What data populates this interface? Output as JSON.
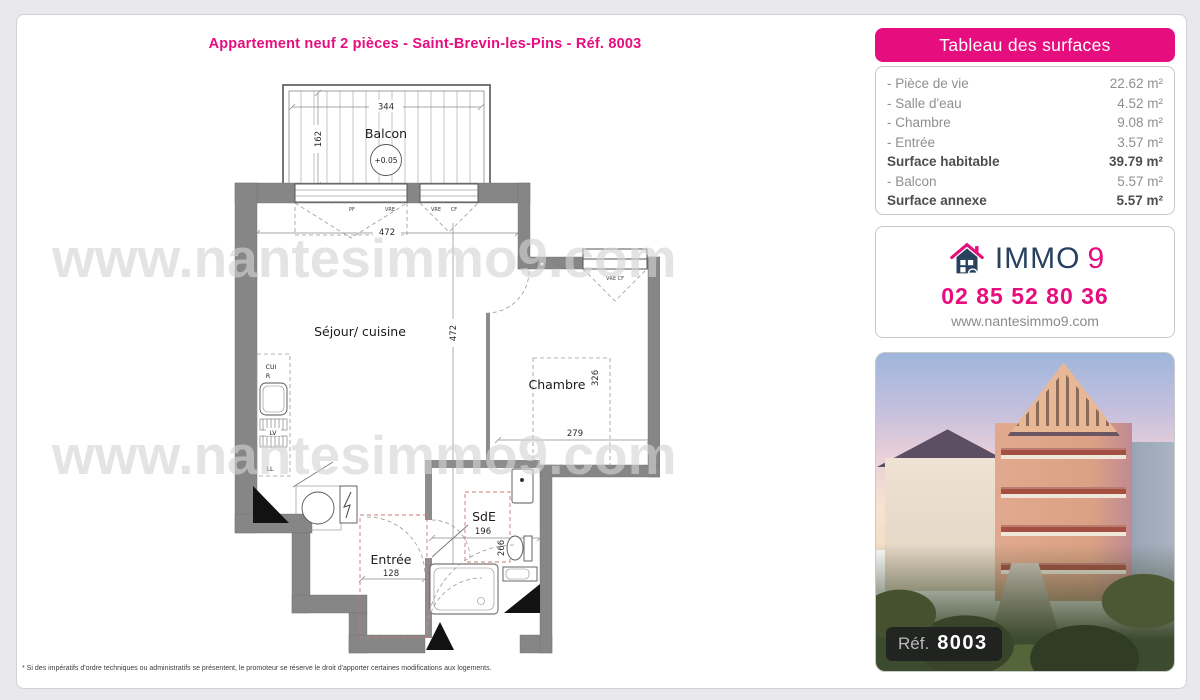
{
  "page": {
    "title": "Appartement neuf 2 pièces - Saint-Brevin-les-Pins - Réf. 8003",
    "watermark": "www.nantesimmo9.com",
    "footnote": "* Si des impératifs d'ordre techniques ou administratifs se présentent, le promoteur se réserve le droit d'apporter certaines modifications aux logements."
  },
  "surfaces_table": {
    "header": "Tableau des surfaces",
    "rows": [
      {
        "label": "- Pièce de vie",
        "value": "22.62 m²"
      },
      {
        "label": "- Salle d'eau",
        "value": "4.52 m²"
      },
      {
        "label": "- Chambre",
        "value": "9.08 m²"
      },
      {
        "label": "- Entrée",
        "value": "3.57 m²"
      },
      {
        "label": "Surface habitable",
        "value": "39.79 m²"
      },
      {
        "label": "- Balcon",
        "value": "5.57 m²"
      },
      {
        "label": "Surface annexe",
        "value": "5.57 m²"
      }
    ]
  },
  "contact": {
    "brand_immo": "IMMO",
    "brand_nine": "9",
    "phone": "02 85 52 80 36",
    "website": "www.nantesimmo9.com"
  },
  "photo": {
    "ref_label": "Réf.",
    "ref_number": "8003"
  },
  "plan": {
    "rooms": {
      "balcon": "Balcon",
      "sejour": "Séjour/ cuisine",
      "chambre": "Chambre",
      "sde": "SdE",
      "entree": "Entrée"
    },
    "elevation": "+0.05",
    "dims": {
      "balcon_w": "344",
      "balcon_h": "162",
      "sejour_w": "472",
      "sejour_h": "472",
      "chambre_w": "279",
      "chambre_h": "326",
      "sde_w": "196",
      "sde_h": "266",
      "entree_w": "128"
    },
    "window_labels": {
      "pf": "PF",
      "vre1": "VRE",
      "vre2": "VRE",
      "cf": "CF",
      "vre_cf": "VRE  CF"
    },
    "kitchen": {
      "cui": "CUI",
      "r": "R",
      "lv": "LV",
      "ll": "LL"
    }
  }
}
